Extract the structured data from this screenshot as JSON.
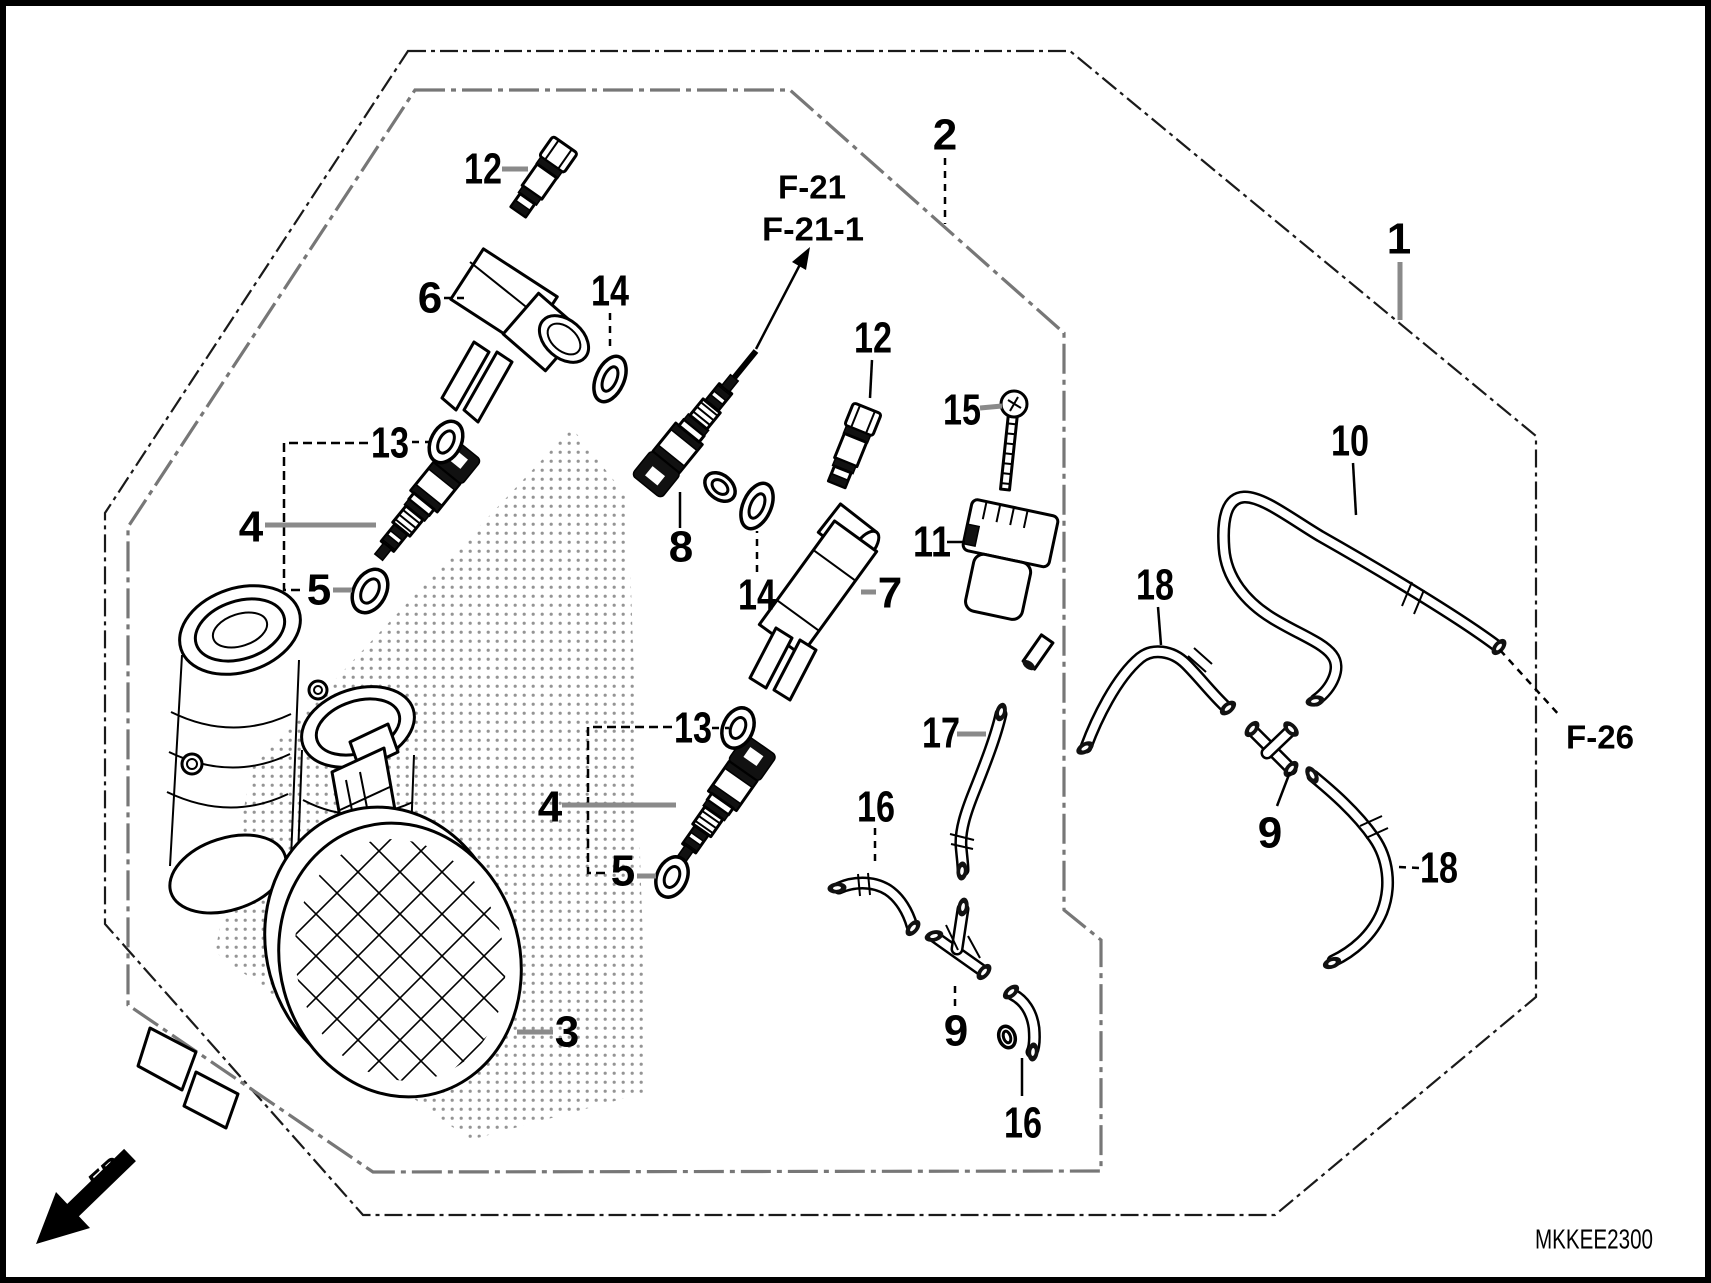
{
  "doc": {
    "code": "MKKEE2300",
    "fr_label": "FR.",
    "background": "#ffffff",
    "ink": "#000000",
    "leader_gray": "#8a8a8a"
  },
  "reference_pages": [
    "F-21",
    "F-21-1",
    "F-26"
  ],
  "part_numbers_visible": [
    1,
    2,
    3,
    4,
    5,
    6,
    7,
    8,
    9,
    10,
    11,
    12,
    13,
    14,
    15,
    16,
    17,
    18
  ],
  "callouts": [
    {
      "id": "callout-12-top",
      "text": "12",
      "x": 483,
      "y": 169,
      "size": 44,
      "style": "gray",
      "leader": [
        [
          502,
          169
        ],
        [
          528,
          169
        ]
      ]
    },
    {
      "id": "callout-6",
      "text": "6",
      "x": 430,
      "y": 298,
      "size": 44,
      "style": "dash",
      "leader": [
        [
          444,
          298
        ],
        [
          468,
          298
        ]
      ]
    },
    {
      "id": "callout-14-top",
      "text": "14",
      "x": 610,
      "y": 291,
      "size": 44,
      "style": "dash",
      "leader": [
        [
          610,
          313
        ],
        [
          610,
          352
        ]
      ]
    },
    {
      "id": "callout-2",
      "text": "2",
      "x": 945,
      "y": 135,
      "size": 44,
      "style": "dash",
      "leader": [
        [
          945,
          158
        ],
        [
          945,
          224
        ]
      ]
    },
    {
      "id": "callout-1",
      "text": "1",
      "x": 1399,
      "y": 239,
      "size": 44,
      "style": "gray",
      "leader": [
        [
          1400,
          262
        ],
        [
          1400,
          320
        ]
      ]
    },
    {
      "id": "callout-12-mid",
      "text": "12",
      "x": 873,
      "y": 338,
      "size": 44,
      "style": "black",
      "leader": [
        [
          872,
          360
        ],
        [
          870,
          398
        ]
      ]
    },
    {
      "id": "callout-15",
      "text": "15",
      "x": 962,
      "y": 410,
      "size": 44,
      "style": "gray",
      "leader": [
        [
          980,
          408
        ],
        [
          1002,
          406
        ]
      ]
    },
    {
      "id": "callout-11",
      "text": "11",
      "x": 932,
      "y": 542,
      "size": 44,
      "style": "black",
      "leader": [
        [
          947,
          542
        ],
        [
          965,
          542
        ]
      ]
    },
    {
      "id": "callout-7",
      "text": "7",
      "x": 890,
      "y": 593,
      "size": 44,
      "style": "gray",
      "leader": [
        [
          876,
          592
        ],
        [
          861,
          592
        ]
      ]
    },
    {
      "id": "callout-14-mid",
      "text": "14",
      "x": 757,
      "y": 595,
      "size": 44,
      "style": "dash",
      "leader": [
        [
          757,
          572
        ],
        [
          757,
          531
        ]
      ]
    },
    {
      "id": "callout-8",
      "text": "8",
      "x": 681,
      "y": 547,
      "size": 44,
      "style": "black",
      "leader": [
        [
          680,
          528
        ],
        [
          680,
          492
        ]
      ]
    },
    {
      "id": "callout-13-upper",
      "text": "13",
      "x": 390,
      "y": 443,
      "size": 44,
      "style": "dash",
      "leader": [
        [
          412,
          442
        ],
        [
          429,
          442
        ]
      ]
    },
    {
      "id": "callout-4-upper",
      "text": "4",
      "x": 251,
      "y": 527,
      "size": 44,
      "style": "gray",
      "leader": [
        [
          265,
          525
        ],
        [
          376,
          525
        ]
      ]
    },
    {
      "id": "callout-5-upper",
      "text": "5",
      "x": 319,
      "y": 590,
      "size": 44,
      "style": "gray",
      "leader": [
        [
          333,
          590
        ],
        [
          352,
          590
        ]
      ]
    },
    {
      "id": "callout-13-lower",
      "text": "13",
      "x": 693,
      "y": 728,
      "size": 44,
      "style": "dash",
      "leader": [
        [
          712,
          728
        ],
        [
          729,
          728
        ]
      ]
    },
    {
      "id": "callout-4-lower",
      "text": "4",
      "x": 550,
      "y": 807,
      "size": 44,
      "style": "gray",
      "leader": [
        [
          562,
          805
        ],
        [
          676,
          805
        ]
      ]
    },
    {
      "id": "callout-5-lower",
      "text": "5",
      "x": 623,
      "y": 871,
      "size": 44,
      "style": "gray",
      "leader": [
        [
          637,
          876
        ],
        [
          656,
          876
        ]
      ]
    },
    {
      "id": "callout-3",
      "text": "3",
      "x": 567,
      "y": 1032,
      "size": 44,
      "style": "gray",
      "leader": [
        [
          517,
          1032
        ],
        [
          553,
          1032
        ]
      ]
    },
    {
      "id": "callout-17",
      "text": "17",
      "x": 941,
      "y": 733,
      "size": 44,
      "style": "gray",
      "leader": [
        [
          957,
          734
        ],
        [
          986,
          734
        ]
      ]
    },
    {
      "id": "callout-16-left",
      "text": "16",
      "x": 876,
      "y": 807,
      "size": 44,
      "style": "dash",
      "leader": [
        [
          875,
          828
        ],
        [
          875,
          866
        ]
      ]
    },
    {
      "id": "callout-9-bottom",
      "text": "9",
      "x": 956,
      "y": 1031,
      "size": 44,
      "style": "dash",
      "leader": [
        [
          955,
          986
        ],
        [
          955,
          1012
        ]
      ]
    },
    {
      "id": "callout-16-bottom",
      "text": "16",
      "x": 1023,
      "y": 1123,
      "size": 44,
      "style": "black",
      "leader": [
        [
          1022,
          1058
        ],
        [
          1022,
          1096
        ]
      ]
    },
    {
      "id": "callout-10",
      "text": "10",
      "x": 1350,
      "y": 441,
      "size": 44,
      "style": "black",
      "leader": [
        [
          1353,
          463
        ],
        [
          1356,
          515
        ]
      ]
    },
    {
      "id": "callout-18-left",
      "text": "18",
      "x": 1155,
      "y": 585,
      "size": 44,
      "style": "black",
      "leader": [
        [
          1158,
          607
        ],
        [
          1161,
          645
        ]
      ]
    },
    {
      "id": "callout-9-right",
      "text": "9",
      "x": 1270,
      "y": 833,
      "size": 44,
      "style": "black",
      "leader": [
        [
          1277,
          806
        ],
        [
          1290,
          772
        ]
      ]
    },
    {
      "id": "callout-18-right",
      "text": "18",
      "x": 1439,
      "y": 868,
      "size": 44,
      "style": "dash",
      "leader": [
        [
          1399,
          867
        ],
        [
          1419,
          868
        ]
      ]
    },
    {
      "id": "ref-f21",
      "text": "F-21",
      "x": 812,
      "y": 187,
      "size": 33,
      "bold": true,
      "style": "none",
      "leader": []
    },
    {
      "id": "ref-f21-1",
      "text": "F-21-1",
      "x": 813,
      "y": 229,
      "size": 33,
      "bold": true,
      "style": "none",
      "leader": []
    },
    {
      "id": "ref-f26",
      "text": "F-26",
      "x": 1600,
      "y": 737,
      "size": 33,
      "bold": true,
      "style": "dash",
      "leader": [
        [
          1500,
          650
        ],
        [
          1560,
          716
        ]
      ]
    }
  ],
  "brackets": [
    {
      "id": "bracket-upper-group",
      "points": [
        [
          368,
          443
        ],
        [
          284,
          443
        ],
        [
          284,
          590
        ],
        [
          304,
          590
        ]
      ]
    },
    {
      "id": "bracket-lower-group",
      "points": [
        [
          672,
          727
        ],
        [
          588,
          727
        ],
        [
          588,
          873
        ],
        [
          610,
          873
        ]
      ]
    }
  ]
}
